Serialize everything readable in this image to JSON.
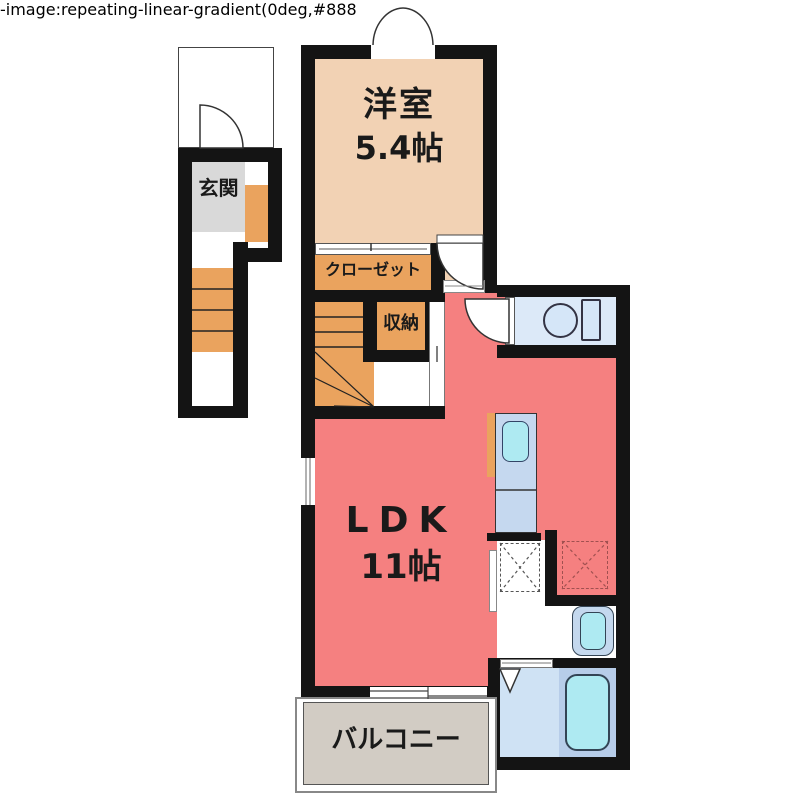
{
  "floor_plan": {
    "rooms": {
      "western_room": {
        "name": "洋室",
        "size": "5.4帖"
      },
      "ldk": {
        "name": "LDK",
        "size": "11帖"
      },
      "closet": {
        "label": "クローゼット"
      },
      "storage": {
        "label": "収納"
      },
      "entrance": {
        "label": "玄関"
      },
      "balcony": {
        "label": "バルコニー"
      }
    },
    "fixtures": [
      "toilet",
      "washbasin",
      "bathtub",
      "kitchen-sink",
      "washing-machine-space",
      "refrigerator-space",
      "staircase",
      "entrance-door"
    ],
    "colors": {
      "wall": "#141414",
      "western_room_floor": "#f2d2b4",
      "ldk_floor": "#f58080",
      "wood_steps": "#eaa35e",
      "entrance_floor": "#d9d9d9",
      "balcony_floor": "#d2ccc4",
      "wet_area_floor": "#dce9f8",
      "fixture_fill": "#aeeaf2"
    }
  }
}
